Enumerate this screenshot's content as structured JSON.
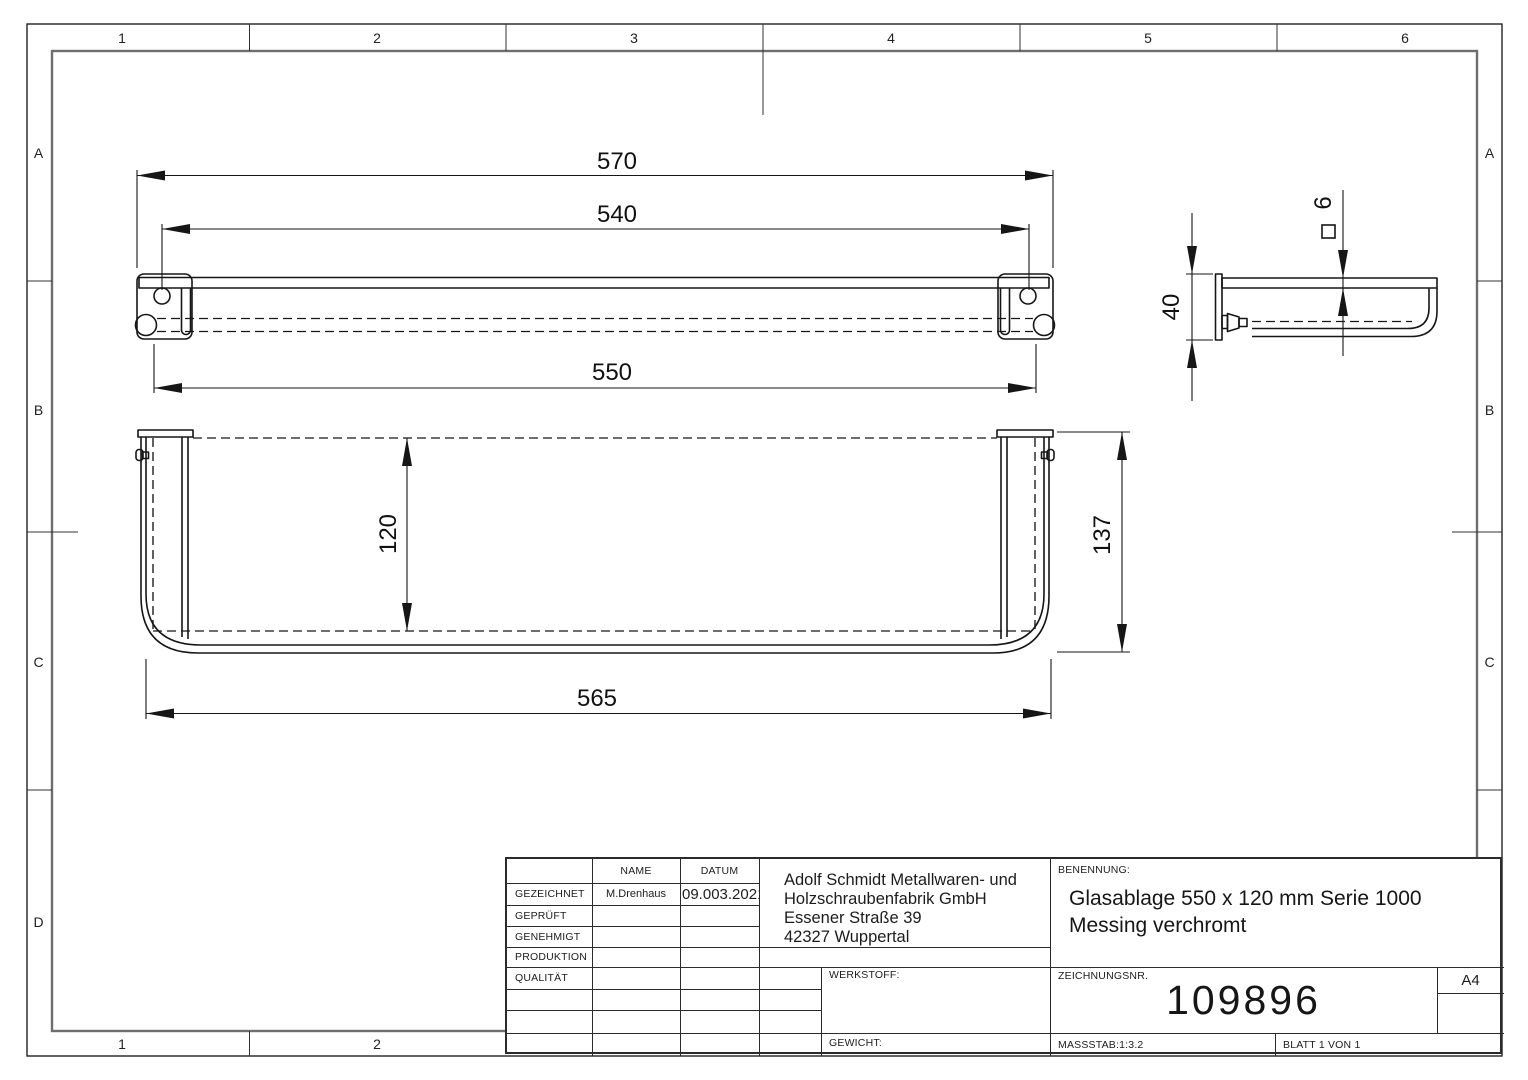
{
  "sheet": {
    "columns": [
      "1",
      "2",
      "3",
      "4",
      "5",
      "6"
    ],
    "bottom_columns": [
      "1",
      "2"
    ],
    "rows_left": [
      "A",
      "B",
      "C",
      "D"
    ],
    "rows_right": [
      "A",
      "B",
      "C"
    ],
    "line_color": "#161616",
    "frame_color": "#6e6e6e"
  },
  "views": {
    "front": {
      "overall": "570",
      "hole_spacing": "540",
      "rail_length": "550"
    },
    "plan": {
      "glass_depth": "120",
      "overall_width": "565",
      "overall_depth": "137"
    },
    "side": {
      "bracket_height": "40",
      "glass_thickness": "6"
    }
  },
  "title_block": {
    "headers": {
      "name": "NAME",
      "date": "DATUM"
    },
    "rows": [
      {
        "label": "GEZEICHNET",
        "name": "M.Drenhaus",
        "date": "09.003.2021"
      },
      {
        "label": "GEPRÜFT",
        "name": "",
        "date": ""
      },
      {
        "label": "GENEHMIGT",
        "name": "",
        "date": ""
      },
      {
        "label": "PRODUKTION",
        "name": "",
        "date": ""
      },
      {
        "label": "QUALITÄT",
        "name": "",
        "date": ""
      }
    ],
    "company": {
      "lines": [
        "Adolf Schmidt Metallwaren- und",
        "Holzschraubenfabrik GmbH",
        "Essener Straße 39",
        "42327 Wuppertal"
      ]
    },
    "benennung_label": "BENENNUNG:",
    "benennung_line1": "Glasablage 550 x 120 mm Serie 1000",
    "benennung_line2": "Messing verchromt",
    "werkstoff_label": "WERKSTOFF:",
    "gewicht_label": "GEWICHT:",
    "zeichnungsnr_label": "ZEICHNUNGSNR.",
    "zeichnungsnr": "109896",
    "format": "A4",
    "massstab": "MASSSTAB:1:3.2",
    "blatt": "BLATT 1 VON 1"
  }
}
